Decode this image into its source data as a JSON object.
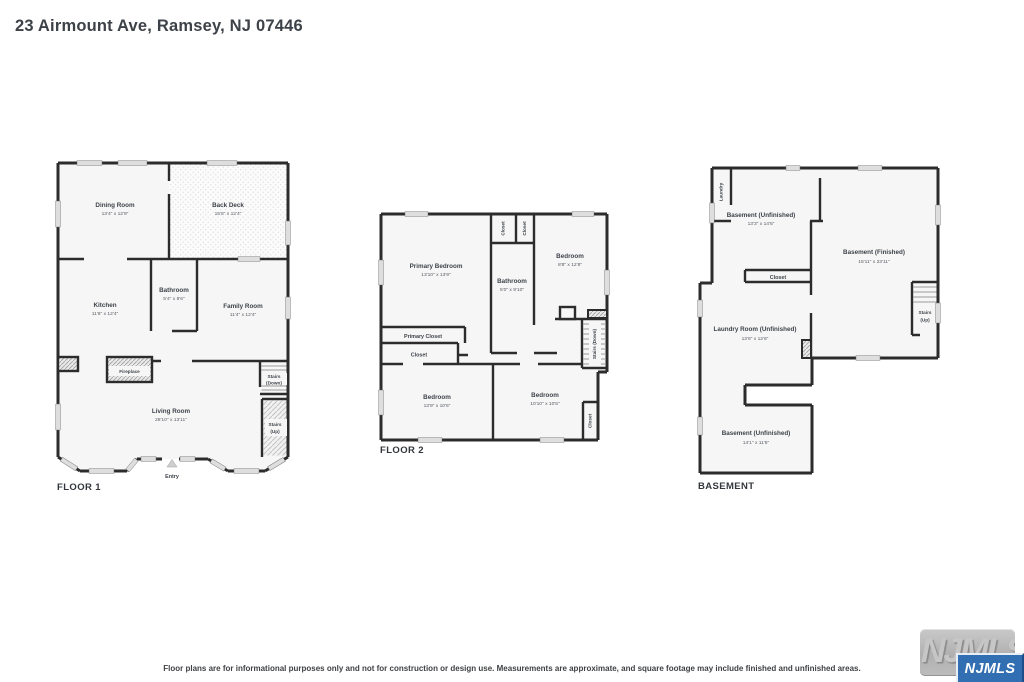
{
  "title": "23 Airmount Ave, Ramsey, NJ 07446",
  "disclaimer": "Floor plans are for informational purposes only and not for construction or design use. Measurements are approximate, and square footage may include finished and unfinished areas.",
  "logo": {
    "watermark_text": "NJMLS",
    "badge_text": "NJMLS",
    "badge_color": "#326fb2"
  },
  "colors": {
    "wall": "#2c2c2c",
    "room_fill": "#f6f6f6",
    "badge_blue": "#326fb2"
  },
  "floor1": {
    "label": "FLOOR 1",
    "entry_label": "Entry",
    "rooms": {
      "dining_room": {
        "name": "Dining Room",
        "dims": "13'4\" x 12'9\""
      },
      "back_deck": {
        "name": "Back Deck",
        "dims": "15'5\" x 12'4\""
      },
      "kitchen": {
        "name": "Kitchen",
        "dims": "11'6\" x 12'4\""
      },
      "bathroom": {
        "name": "Bathroom",
        "dims": "5'4\" x 8'6\""
      },
      "family_room": {
        "name": "Family Room",
        "dims": "11'4\" x 12'4\""
      },
      "living_room": {
        "name": "Living Room",
        "dims": "28'10\" x 13'11\""
      },
      "fireplace": {
        "name": "Fireplace"
      },
      "stairs_down": {
        "line1": "Stairs",
        "line2": "(Down)"
      },
      "stairs_up": {
        "line1": "Stairs",
        "line2": "(Up)"
      }
    }
  },
  "floor2": {
    "label": "FLOOR 2",
    "rooms": {
      "primary_bedroom": {
        "name": "Primary Bedroom",
        "dims": "13'10\" x 13'9\""
      },
      "closet_a": {
        "name": "Closet"
      },
      "closet_b": {
        "name": "Closet"
      },
      "bathroom": {
        "name": "Bathroom",
        "dims": "5'0\" x 9'10\""
      },
      "bedroom_right": {
        "name": "Bedroom",
        "dims": "8'8\" x 12'8\""
      },
      "primary_closet": {
        "name": "Primary Closet"
      },
      "closet_hall": {
        "name": "Closet"
      },
      "bedroom_bottom_left": {
        "name": "Bedroom",
        "dims": "13'9\" x 10'5\""
      },
      "bedroom_bottom_mid": {
        "name": "Bedroom",
        "dims": "10'10\" x 10'5\""
      },
      "stairs_down": {
        "name": "Stairs (Down)"
      },
      "closet_corner": {
        "name": "Closet"
      }
    }
  },
  "basement": {
    "label": "BASEMENT",
    "rooms": {
      "laundry": {
        "name": "Laundry"
      },
      "unfinished_top": {
        "name": "Basement (Unfinished)",
        "dims": "13'3\" x 14'5\""
      },
      "finished": {
        "name": "Basement (Finished)",
        "dims": "15'11\" x 23'11\""
      },
      "closet": {
        "name": "Closet"
      },
      "stairs_up": {
        "line1": "Stairs",
        "line2": "(Up)"
      },
      "laundry_room": {
        "name": "Laundry Room (Unfinished)",
        "dims": "13'6\" x 12'6\""
      },
      "unfinished_bottom": {
        "name": "Basement (Unfinished)",
        "dims": "14'1\" x 11'5\""
      }
    }
  }
}
